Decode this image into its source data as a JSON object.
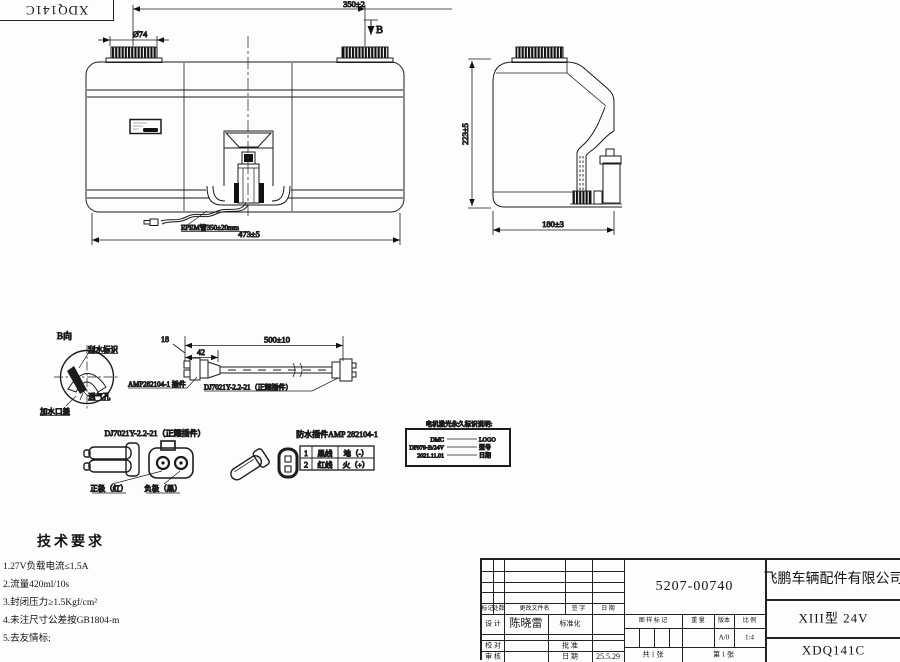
{
  "corner_stamp": {
    "code": "XDQ141C"
  },
  "front_view": {
    "dim_caps_distance": "350±2",
    "dim_cap_diameter": "Ø74",
    "view_label": "B",
    "dim_overall_width": "473±5",
    "hose_label": "EPEM管350±20mm"
  },
  "side_view": {
    "dim_height": "223±5",
    "dim_depth": "180±3"
  },
  "view_b": {
    "title": "B向",
    "wiper_mark_label": "刮水标识",
    "vent_hole_label": "透气孔",
    "filler_cap_label": "加水口盖"
  },
  "harness": {
    "dim_connector": "18",
    "dim_boot": "42",
    "dim_length": "500±10",
    "amp_label": "AMP282104-1 插件",
    "dj_label": "DJ7021Y-2.2-21（正耀插件）"
  },
  "dj_detail": {
    "title": "DJ7021Y-2.2-21（正耀插件）",
    "positive_label": "正极（红）",
    "negative_label": "负极（黑）"
  },
  "amp_detail": {
    "title": "防水插件AMP 282104-1",
    "pin_table": {
      "rows": [
        {
          "pin": "1",
          "wire": "黑线",
          "signal": "地（-）"
        },
        {
          "pin": "2",
          "wire": "红线",
          "signal": "火（+）"
        }
      ]
    }
  },
  "laser_marking": {
    "title": "电机激光永久标识说明:",
    "rows": [
      {
        "content": "DMC",
        "meaning": "LOGO"
      },
      {
        "content": "DF979-B/24V",
        "meaning": "型号"
      },
      {
        "content": "2021.11.01",
        "meaning": "日期"
      }
    ]
  },
  "tech_requirements": {
    "title": "技术要求",
    "items": [
      "1.27V负载电流≤1.5A",
      "2.流量420ml/10s",
      "3.封闭压力≥1.5Kgf/cm²",
      "4.未注尺寸公差按GB1804-m",
      "5.去友情标;"
    ]
  },
  "title_block": {
    "drawing_number": "5207-00740",
    "company": "飞鹏车辆配件有限公司",
    "model": "XIII型 24V",
    "part_code": "XDQ141C",
    "rev_mark": "标记",
    "rev_count": "处数",
    "rev_file": "更改文件名",
    "rev_sign": "签 字",
    "rev_date": "日 期",
    "design": "设 计",
    "designer": "陈晓雷",
    "standardization": "标准化",
    "proofread": "校 对",
    "approve": "批 准",
    "review": "审 核",
    "date_label": "日 期",
    "date_value": "25.5.29",
    "stamp_header": "图 样 标 记",
    "weight_header": "重 量",
    "version_header": "版本",
    "scale_header": "比 例",
    "version_value": "A/0",
    "scale_value": "1:4",
    "total_sheets": "共 1 张",
    "sheet_no": "第 1 张"
  }
}
